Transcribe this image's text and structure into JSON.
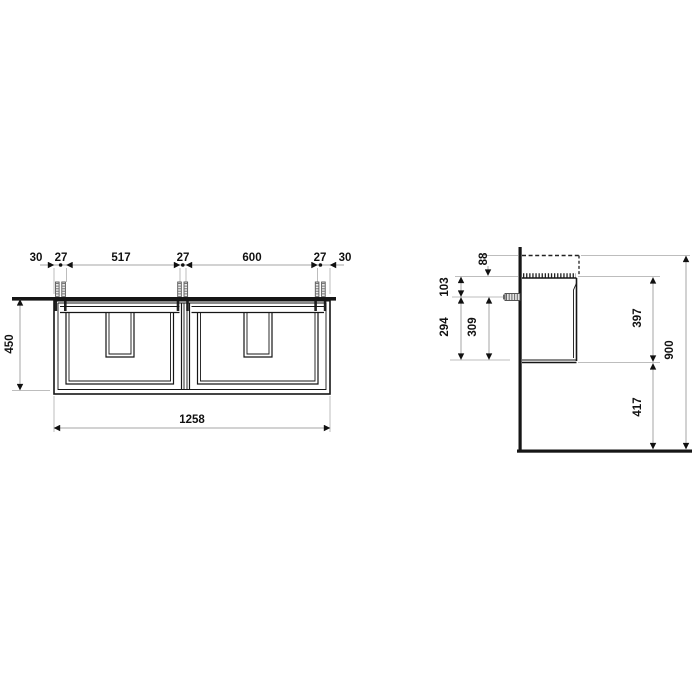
{
  "front_view": {
    "horizontal_chain": {
      "labels": [
        "30",
        "27",
        "517",
        "27",
        "600",
        "27",
        "30"
      ]
    },
    "cabinet_height_mm": "450",
    "cabinet_width_mm": "1258"
  },
  "side_view": {
    "washbasin_height_mm": "88",
    "screw_below_top_mm": "103",
    "screw_to_bottom_outer_mm": "294",
    "screw_to_bottom_inner_mm": "309",
    "cabinet_height_mm": "397",
    "floor_clearance_mm": "417",
    "overall_height_mm": "900"
  }
}
